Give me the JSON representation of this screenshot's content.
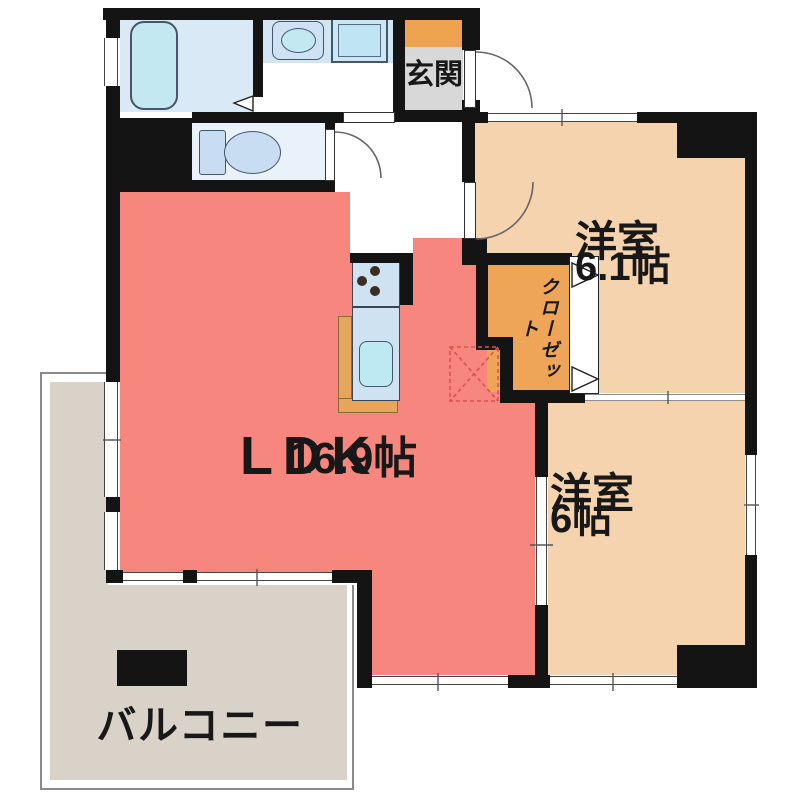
{
  "plan": {
    "type": "apartment-floorplan",
    "rooms": {
      "genkan": {
        "label": "玄関"
      },
      "bedroom1": {
        "label": "洋室",
        "size": "6.1帖"
      },
      "bedroom2": {
        "label": "洋室",
        "size": "6帖"
      },
      "ldk": {
        "label": "LDK",
        "size": "16.9帖"
      },
      "closet": {
        "label": "クローゼット"
      },
      "balcony": {
        "label": "バルコニー"
      }
    },
    "colors": {
      "wall": "#141414",
      "ldk": "#f6867e",
      "bed": "#f4d3ae",
      "closet": "#efa558",
      "genkan_step": "#efa351",
      "genkan_floor": "#d8d8d8",
      "balcony": "#d9d2c8",
      "wet": "#dae9f6",
      "counter_band": "#d3e4f3",
      "fixture": "#c4e8f2",
      "fixture_soft": "#c9ddf2",
      "kitchen_counter_wood": "#e5a55b",
      "fridge_dash": "#d9544a"
    }
  }
}
